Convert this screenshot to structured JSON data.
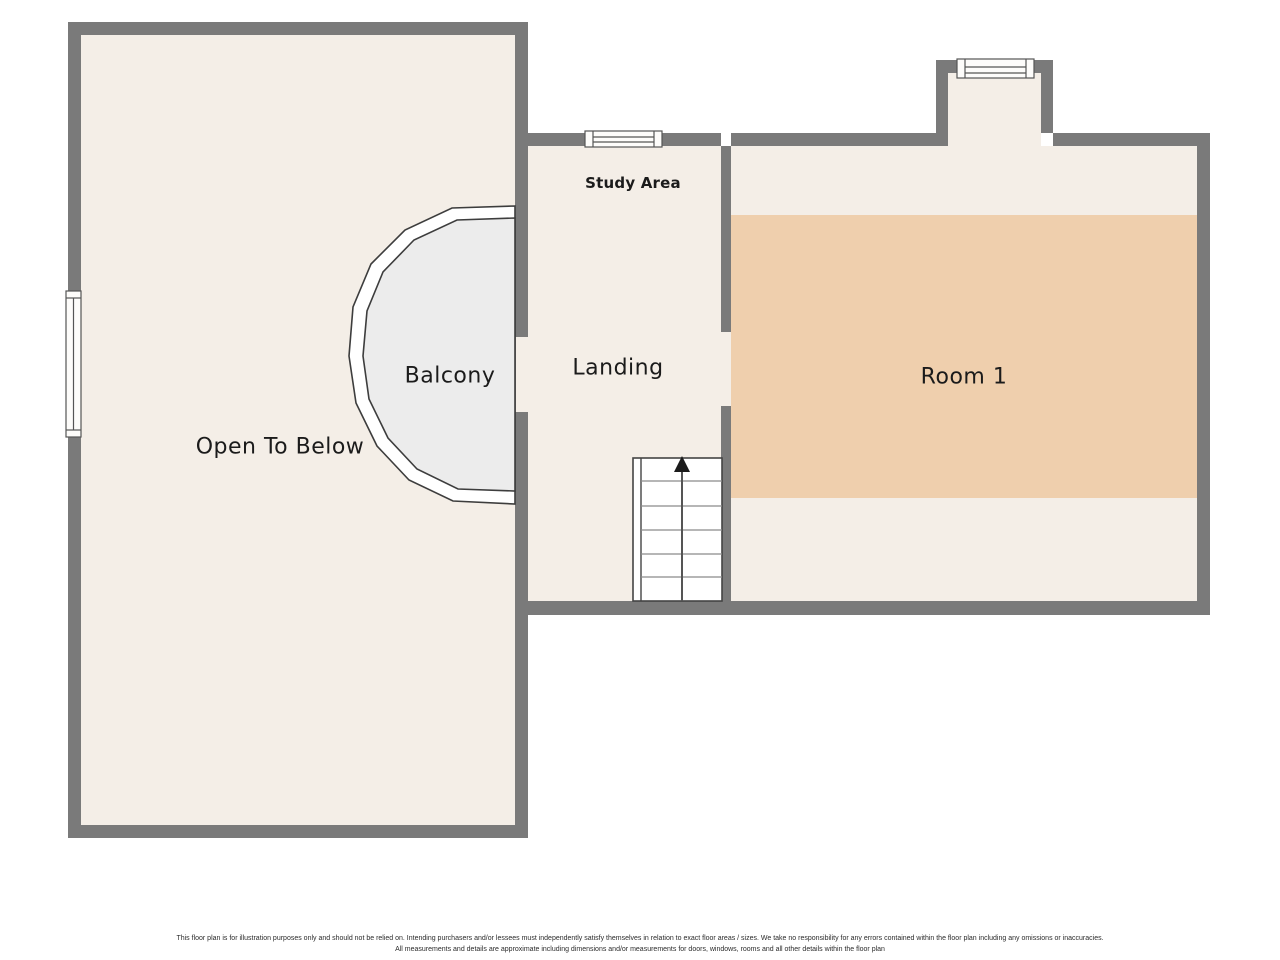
{
  "labels": {
    "open_to_below": "Open To Below",
    "balcony": "Balcony",
    "study_area": "Study Area",
    "landing": "Landing",
    "room_1": "Room 1"
  },
  "disclaimer": {
    "line1": "This floor plan is for illustration purposes only and should not be relied on. Intending purchasers and/or lessees must independently satisfy themselves in relation to exact floor areas / sizes. We take no responsibility for any errors contained within the floor plan including any omissions or inaccuracies.",
    "line2": "All measurements and details are approximate including dimensions and/or measurements for doors, windows, rooms and all other details within the floor plan"
  },
  "icons": {
    "stairs_direction": "up-arrow-icon"
  },
  "colors": {
    "wall": "#7a7a7a",
    "floor": "#f4eee7",
    "room1_accent": "#efcfad",
    "balcony_floor": "#ececec",
    "stairs_fill": "#ffffff",
    "window_fill": "#fdfcfa",
    "outline": "#3d3d3d",
    "tread_line": "#8a8a8a",
    "arrow": "#1b1b1b",
    "text": "#1b1b1b",
    "background": "#ffffff"
  }
}
